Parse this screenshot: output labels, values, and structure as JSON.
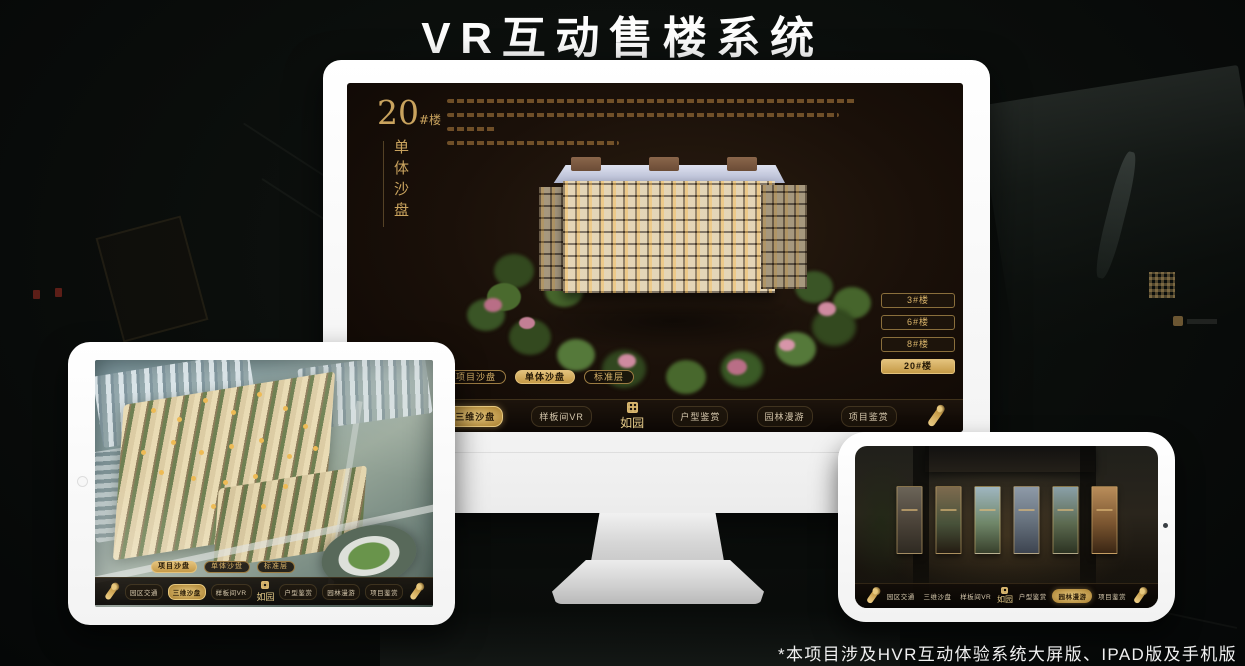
{
  "page": {
    "title": "VR互动售楼系统",
    "footnote": "*本项目涉及HVR互动体验系统大屏版、IPAD版及手机版"
  },
  "colors": {
    "accent_gold": "#d2ab62",
    "gold_selected_bg": "#c59a47",
    "selected_text": "#241806",
    "screen_bg": "#1a1009",
    "nav_text": "#d6c8ad"
  },
  "brand": {
    "logo_text": "如园"
  },
  "monitor_app": {
    "building_no": "20",
    "building_no_suffix": "#楼",
    "subtitle_vertical": "单体沙盘",
    "floor_buttons": [
      {
        "label": "3#楼",
        "selected": false
      },
      {
        "label": "6#楼",
        "selected": false
      },
      {
        "label": "8#楼",
        "selected": false
      },
      {
        "label": "20#楼",
        "selected": true
      }
    ],
    "sub_tabs": [
      {
        "label": "项目沙盘",
        "selected": false
      },
      {
        "label": "单体沙盘",
        "selected": true
      },
      {
        "label": "标准层",
        "selected": false
      }
    ],
    "nav_items": [
      {
        "label": "园区交通",
        "selected": false
      },
      {
        "label": "三维沙盘",
        "selected": true
      },
      {
        "label": "样板间VR",
        "selected": false
      },
      {
        "label": "户型鉴赏",
        "selected": false
      },
      {
        "label": "园林漫游",
        "selected": false
      },
      {
        "label": "项目鉴赏",
        "selected": false
      }
    ]
  },
  "ipad_app": {
    "sub_tabs": [
      {
        "label": "项目沙盘",
        "selected": true
      },
      {
        "label": "单体沙盘",
        "selected": false
      },
      {
        "label": "标准层",
        "selected": false
      }
    ],
    "nav_items": [
      {
        "label": "园区交通",
        "selected": false
      },
      {
        "label": "三维沙盘",
        "selected": true
      },
      {
        "label": "样板间VR",
        "selected": false
      },
      {
        "label": "户型鉴赏",
        "selected": false
      },
      {
        "label": "园林漫游",
        "selected": false
      },
      {
        "label": "项目鉴赏",
        "selected": false
      }
    ]
  },
  "phone_app": {
    "nav_items": [
      {
        "label": "园区交通",
        "selected": false
      },
      {
        "label": "三维沙盘",
        "selected": false
      },
      {
        "label": "样板间VR",
        "selected": false
      },
      {
        "label": "户型鉴赏",
        "selected": false
      },
      {
        "label": "园林漫游",
        "selected": true
      },
      {
        "label": "项目鉴赏",
        "selected": false
      }
    ]
  }
}
